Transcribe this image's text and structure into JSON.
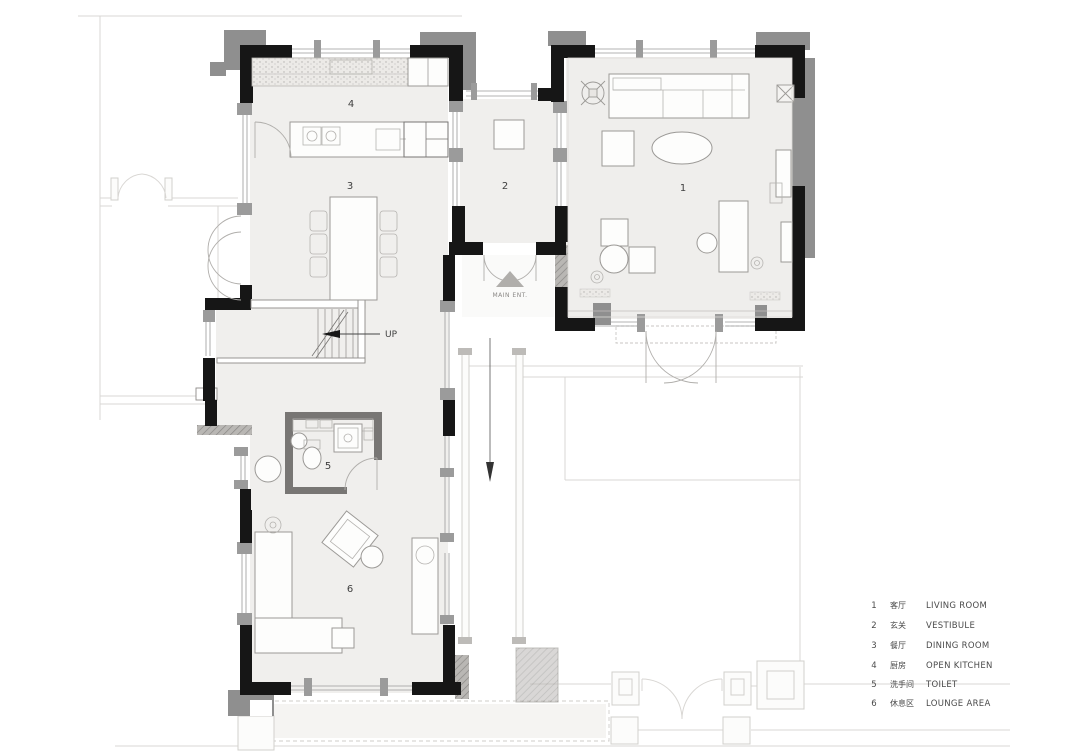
{
  "plan": {
    "rooms": {
      "living": {
        "number": "1"
      },
      "vestibule": {
        "number": "2"
      },
      "dining": {
        "number": "3"
      },
      "kitchen": {
        "number": "4"
      },
      "toilet": {
        "number": "5"
      },
      "lounge": {
        "number": "6"
      }
    },
    "annotations": {
      "up": "UP",
      "main_entrance": "MAIN ENT."
    }
  },
  "legend": {
    "items": [
      {
        "num": "1",
        "zh": "客厅",
        "en": "LIVING ROOM"
      },
      {
        "num": "2",
        "zh": "玄关",
        "en": "VESTIBULE"
      },
      {
        "num": "3",
        "zh": "餐厅",
        "en": "DINING ROOM"
      },
      {
        "num": "4",
        "zh": "厨房",
        "en": "OPEN  KITCHEN"
      },
      {
        "num": "5",
        "zh": "洗手间",
        "en": "TOILET"
      },
      {
        "num": "6",
        "zh": "休息区",
        "en": "LOUNGE AREA"
      }
    ]
  },
  "colors": {
    "wall_black": "#161616",
    "pilaster_gray": "#8f8f8f",
    "floor": "#f0efed",
    "faint_context": "#d9d7d4",
    "text": "#454545"
  }
}
